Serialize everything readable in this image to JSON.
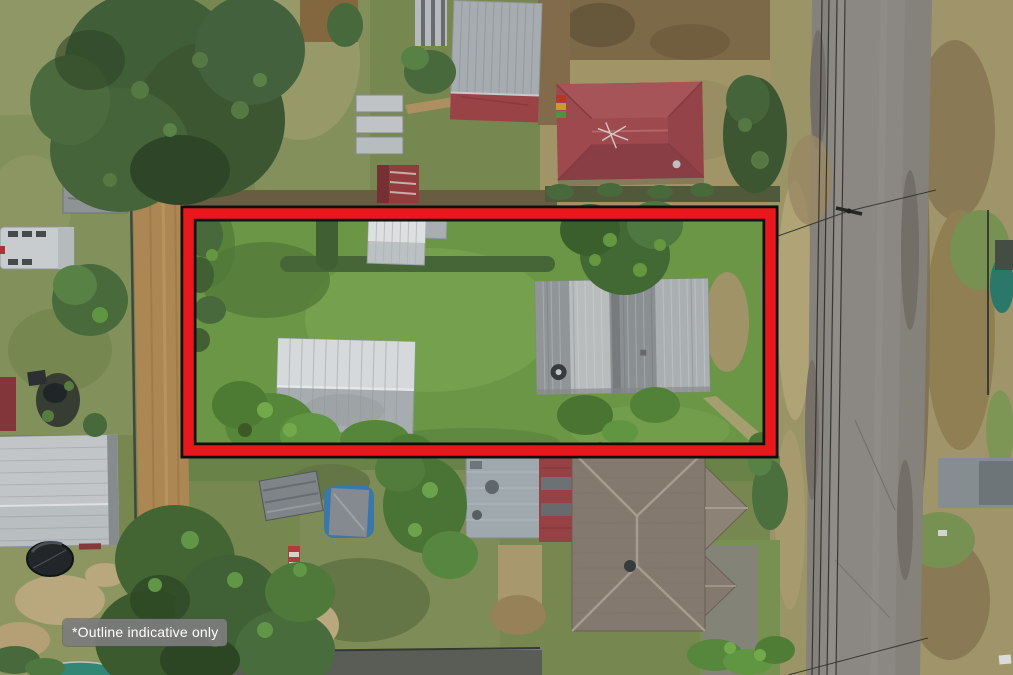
{
  "overlay": {
    "disclaimer_text": "*Outline indicative only"
  },
  "colors": {
    "outline_red": "#e8181c",
    "outline_edge": "#101010",
    "disclaimer_bg": "#7c7c7c",
    "disclaimer_text_color": "#ffffff",
    "road_asphalt": "#8e8a84",
    "dirt_lane": "#b8915a",
    "lot_lawn": "#73a04b",
    "red_roof": "#a84e53",
    "tile_roof": "#8d8276",
    "metal_roof_light": "#e4e8ea",
    "metal_roof_weathered": "#a7acae",
    "tree_green_dark": "#3f5c35",
    "tree_green_bright": "#67a046"
  },
  "scene": {
    "elements": [
      {
        "name": "property-outline",
        "label": "red boundary outline"
      },
      {
        "name": "disclaimer-label",
        "label": "*Outline indicative only"
      },
      {
        "name": "lot-lawn",
        "label": "outlined grass lot"
      },
      {
        "name": "lot-main-house",
        "label": "weathered corrugated roof house"
      },
      {
        "name": "lot-garage",
        "label": "white metal gable shed"
      },
      {
        "name": "lot-white-shed",
        "label": "small white garden shed"
      },
      {
        "name": "red-roof-house",
        "label": "red hip roof house"
      },
      {
        "name": "top-shed",
        "label": "grey/red corrugated shed"
      },
      {
        "name": "tiled-roof-house",
        "label": "brown tiled cross-hip house"
      },
      {
        "name": "blue-metal-roof-house",
        "label": "blue-grey metal roof"
      },
      {
        "name": "garage-roof-bottom-left",
        "label": "large grey garage roof"
      },
      {
        "name": "asphalt-road",
        "label": "street"
      },
      {
        "name": "dirt-lane",
        "label": "dirt side lane"
      },
      {
        "name": "power-lines",
        "label": "overhead wires and pole"
      },
      {
        "name": "trampoline",
        "label": "dark round trampoline"
      },
      {
        "name": "covered-pool",
        "label": "tarp-covered pool"
      },
      {
        "name": "white-truck",
        "label": "white truck/trailer"
      }
    ]
  }
}
